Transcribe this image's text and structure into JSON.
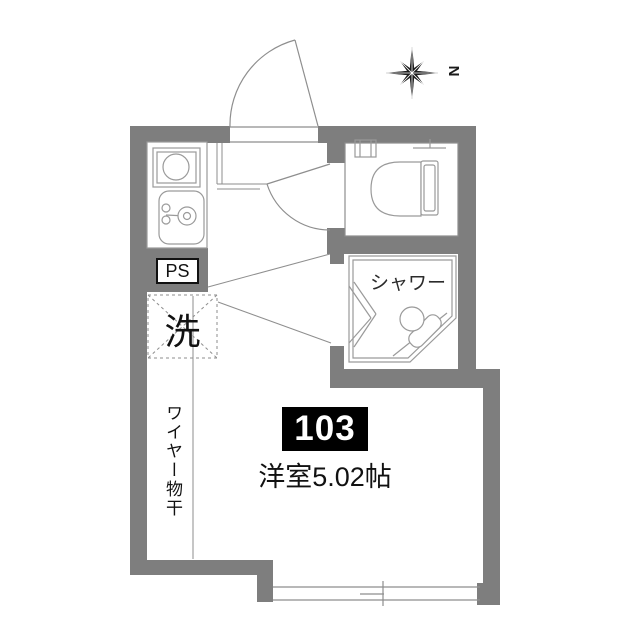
{
  "floorplan": {
    "compass": {
      "label": "N"
    },
    "labels": {
      "ps": "PS",
      "washer": "洗",
      "shower": "シャワー",
      "unit_number": "103",
      "room": "洋室5.02帖",
      "wire": "ワイヤー物干"
    },
    "colors": {
      "wall": "#7e7e7e",
      "line": "#8e8e8e",
      "fixture_line": "#9a9a9a",
      "text": "#111111",
      "badge_bg": "#000000",
      "badge_text": "#ffffff",
      "background": "#ffffff"
    }
  }
}
